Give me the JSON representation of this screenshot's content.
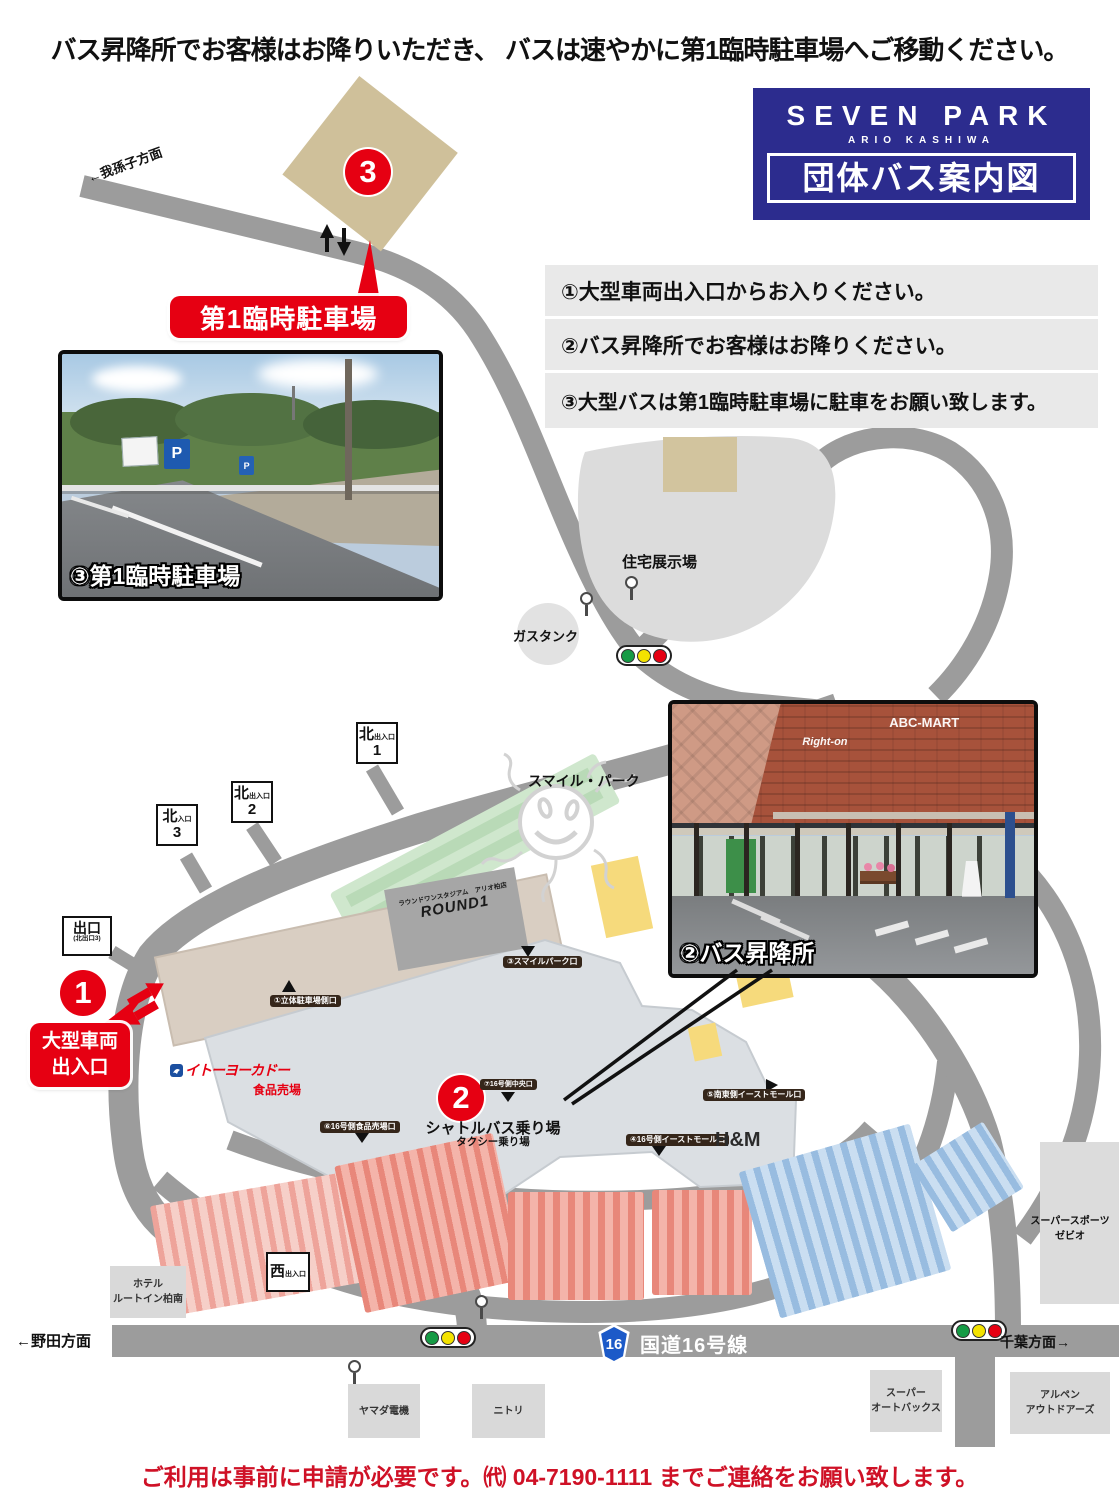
{
  "title_top": "バス昇降所でお客様はお降りいただき、 バスは速やかに第1臨時駐車場へご移動ください。",
  "logo": {
    "brand": "SEVEN PARK",
    "sub": "ARIO KASHIWA",
    "heading": "団体バス案内図"
  },
  "notice": {
    "items": [
      {
        "text": "①大型車両出入口からお入りください。"
      },
      {
        "text": "②バス昇降所でお客様はお降りください。"
      },
      {
        "text": "③大型バスは第1臨時駐車場に駐車をお願い致します。"
      }
    ]
  },
  "markers": {
    "one": "1",
    "two": "2",
    "three": "3"
  },
  "badges": {
    "parking1": "第1臨時駐車場",
    "gate_line1": "大型車両",
    "gate_line2": "出入口",
    "shuttle": "シャトルバス乗り場",
    "taxi": "タクシー乗り場"
  },
  "photos": {
    "parking": {
      "caption": "③第1臨時駐車場",
      "sign_p": "P"
    },
    "busstop": {
      "caption": "②バス昇降所",
      "sign1": "Right-on",
      "sign2": "ABC-MART"
    }
  },
  "directions": {
    "abiko": "←我孫子方面",
    "noda": "←野田方面",
    "chiba": "千葉方面→"
  },
  "places": {
    "housing": "住宅展示場",
    "gastank": "ガスタンク",
    "smilepark": "スマイル・パーク",
    "round1_store": "ラウンドワンスタジアム　アリオ柏店",
    "round1": "ROUND1",
    "itoyokado": "イトーヨーカドー",
    "food": "食品売場",
    "hm": "H&M",
    "hotel": "ホテル\nルートイン柏南",
    "yamada": "ヤマダ電機",
    "nitori": "ニトリ",
    "autobacs": "スーパー\nオートバックス",
    "alpen": "アルペン\nアウトドアーズ",
    "xebio": "スーパースポーツ\nゼビオ"
  },
  "route16": {
    "shield": "16",
    "name": "国道16号線"
  },
  "gates_big": {
    "north1": {
      "big": "北",
      "small": "出入口",
      "num": "1"
    },
    "north2": {
      "big": "北",
      "small": "出入口",
      "num": "2"
    },
    "north3": {
      "big": "北",
      "small": "入口",
      "num": "3"
    },
    "exit3": {
      "line1": "出口",
      "line2": "(北出口3)"
    },
    "west": {
      "big": "西",
      "small": "出入口"
    }
  },
  "gates_small": {
    "g1": "①立体駐車場側口",
    "g2": "③スマイルパーク口",
    "g3": "⑦16号側中央口",
    "g4": "⑥16号側食品売場口",
    "g5": "⑤南東側イーストモール口",
    "g6": "④16号側イーストモール口"
  },
  "footer": "ご利用は事前に申請が必要です。㈹ 04-7190-1111 までご連絡をお願い致します。"
}
